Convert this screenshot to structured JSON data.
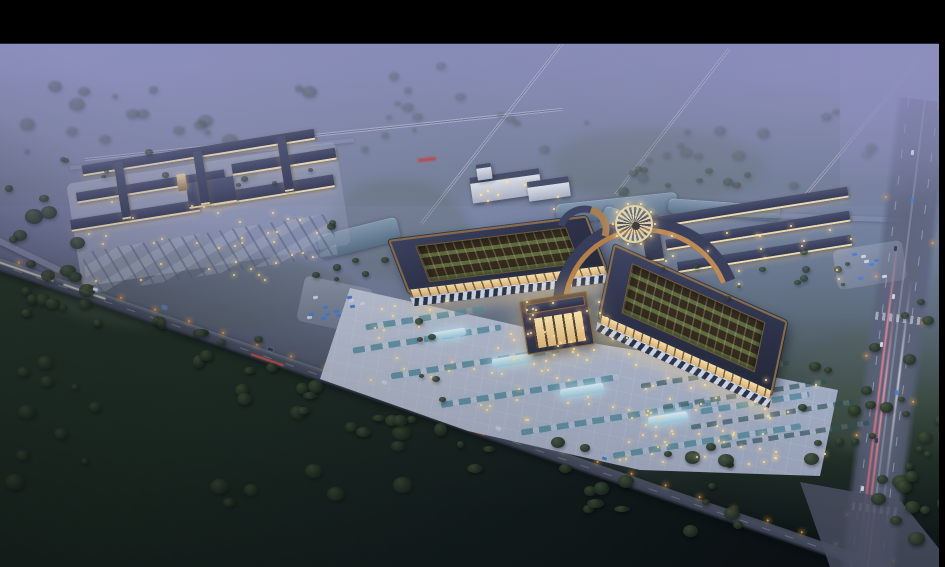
{
  "scene": {
    "type": "architectural-rendering",
    "view": "aerial-oblique",
    "time_of_day": "dusk",
    "subject": "illuminated traditional-roof market complex with plaza, parking, pond, roads and fields",
    "regions": {
      "letterbox_top": "black band across top",
      "letterbox_right": "thin black band at right edge",
      "misty_farmland": "hazy lavender fields with diagonal rural roads, upper half",
      "left_market_complex": "cluster of long lit buildings with parking, left",
      "main_pavilion_west": "large courtyard-roof hall, center",
      "main_pavilion_east": "large courtyard-roof hall with curved copper sweep, right of center",
      "central_gate": "glowing entry hall between pavilions",
      "front_plaza": "bright paved plaza with parking rows and fountains",
      "round_plaza": "circular patterned waterfront platform",
      "pond": "dark reflective water north of pavilions",
      "row_buildings": "three long shop rows, upper right",
      "approach_road": "diagonal lit road across foreground",
      "highway": "wide vertical road with light trails, right edge",
      "dark_fields": "near-black tree-dotted fields, lower left"
    }
  },
  "palette": {
    "letterbox": "#000000",
    "haze_top": "#8d90bd",
    "mist": "#8a8cc0",
    "field": "#1c2a22",
    "forest": "#3c4852",
    "tree": "#1f2c21",
    "tree_light": "#41523a",
    "road": "#4b5266",
    "road_light": "#9aa1b8",
    "highway": "#5c6378",
    "lane_mark": "#d0d5e6",
    "streak_pink": "#e8879a",
    "streak_red": "#d9534a",
    "water": "#5b7289",
    "water_light": "#8298ae",
    "plaza": "#c9d0e0",
    "plaza_dark": "#96a1b9",
    "roof": "#2c3148",
    "copper": "#8a6a46",
    "copper_bright": "#c08a52",
    "court_green": "#5f7342",
    "glow": "#f7e2ae",
    "canopy": "#ccd6e6",
    "teal": "#4682a0",
    "fountain": "#bfe3ef",
    "cream": "#e8dbb4",
    "car_white": "#cdd6e8",
    "car_blue": "#4d7fd0",
    "light_warm": "#ffe8b0",
    "light_orange": "#f0a050"
  },
  "generated_detail": {
    "tree_clusters": 170,
    "plaza_lights": 128,
    "street_lights": 27,
    "vehicles": 38
  }
}
